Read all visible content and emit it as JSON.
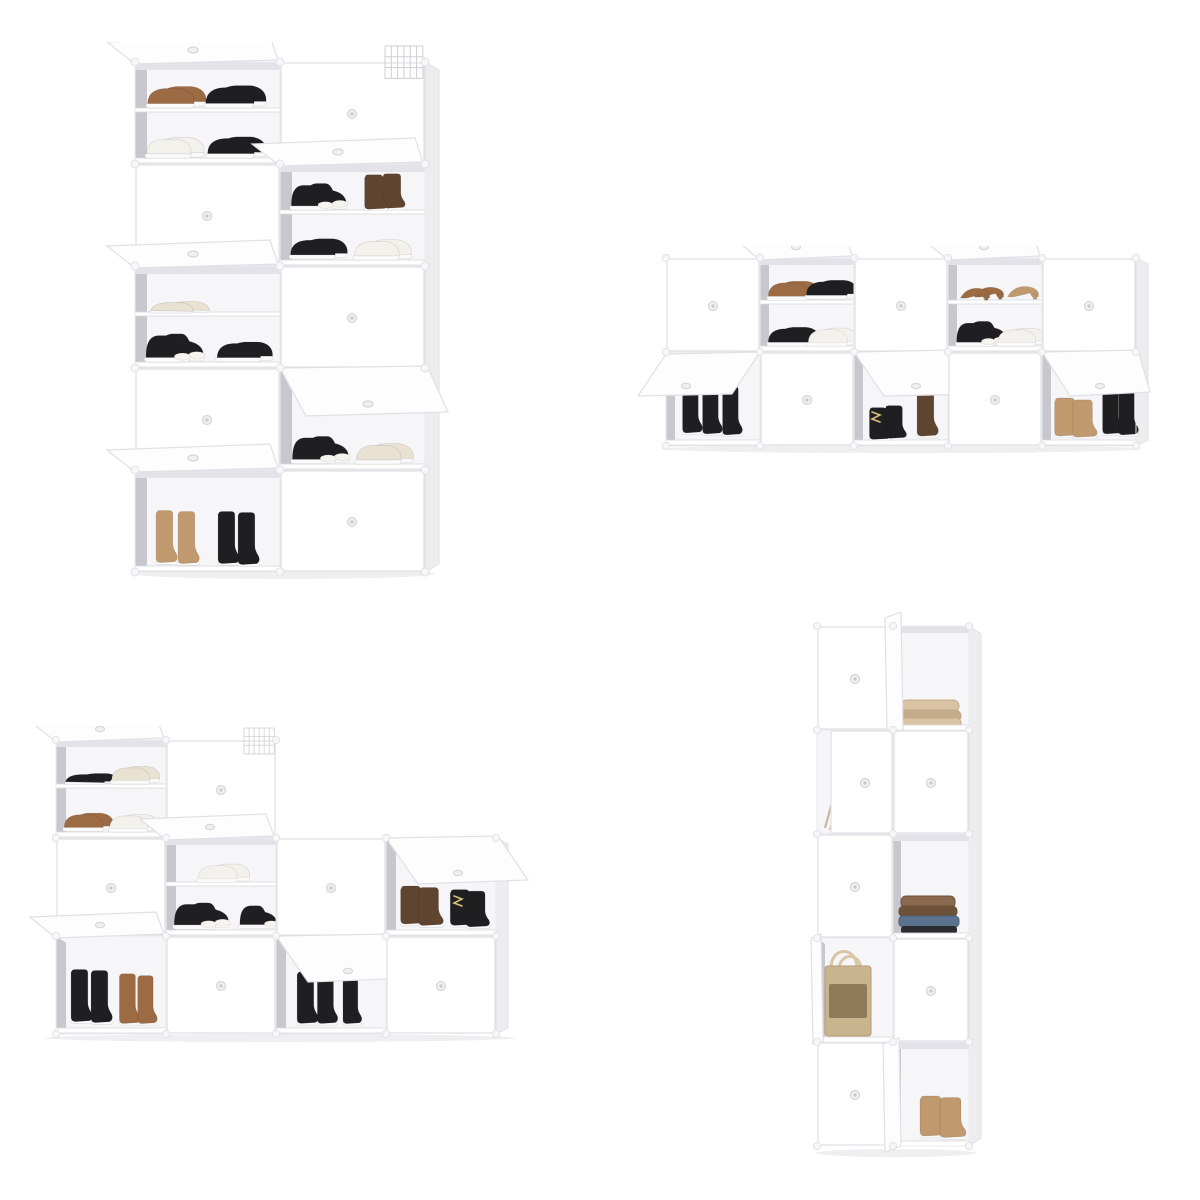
{
  "palette": {
    "page-bg": "#ffffff",
    "cabinet-white": "#ffffff",
    "flap-white": "#fdfdfe",
    "panel-edge": "#e0e0e6",
    "seam": "#ebebef",
    "side-face": "#ededf0",
    "interior-back": "#f6f6f8",
    "interior-wall": "#c7c7cd",
    "interior-shadow": "#e2e2e8",
    "shelf-edge": "#d9d9de",
    "knob": "#d6d6db",
    "knob-dot": "#c9c9cf",
    "connector": "#f7f7f9",
    "wire": "#cfcfd4",
    "sole": "#fafafa",
    "ground-shadow": "#dcdce1",
    "lace-yellow": "#d9c17c",
    "shoe-black": "#1f1f22",
    "shoe-brown": "#9c6b43",
    "shoe-tan": "#c09a6e",
    "shoe-dark-brown": "#5f4430",
    "shoe-white": "#f3f1ec",
    "shoe-cream": "#e9e2d3",
    "fabric-beige": "#d9c3a4",
    "fabric-beige-dark": "#c4ac8a",
    "fabric-brown": "#8a6a4e",
    "fabric-brown-dark": "#6d5138",
    "denim-blue": "#5c7390",
    "bag-straw": "#c9b48e",
    "bag-pattern": "#7c6747",
    "stick-tan": "#cbb79b"
  },
  "panels": [
    {
      "id": "tall-shoe-rack",
      "label": "Tall seven-tier white cube shoe cabinet, two cubes wide, with open flip doors showing sneakers and boots",
      "columns": 2,
      "rows": 5
    },
    {
      "id": "wide-shoe-rack",
      "label": "Wide two-tier white cube shoe rack, five cubes across, with open flip doors showing shoes and boots",
      "columns": 5,
      "rows": 2
    },
    {
      "id": "step-shoe-rack",
      "label": "Staircase-shaped white cube shoe rack with open flip doors showing sneakers and boots",
      "columns": 4,
      "rows": 3
    },
    {
      "id": "storage-tower",
      "label": "Narrow five-tier white cube storage tower holding a blanket, folded clothes, a straw bag and boots",
      "columns": 2,
      "rows": 5
    }
  ]
}
